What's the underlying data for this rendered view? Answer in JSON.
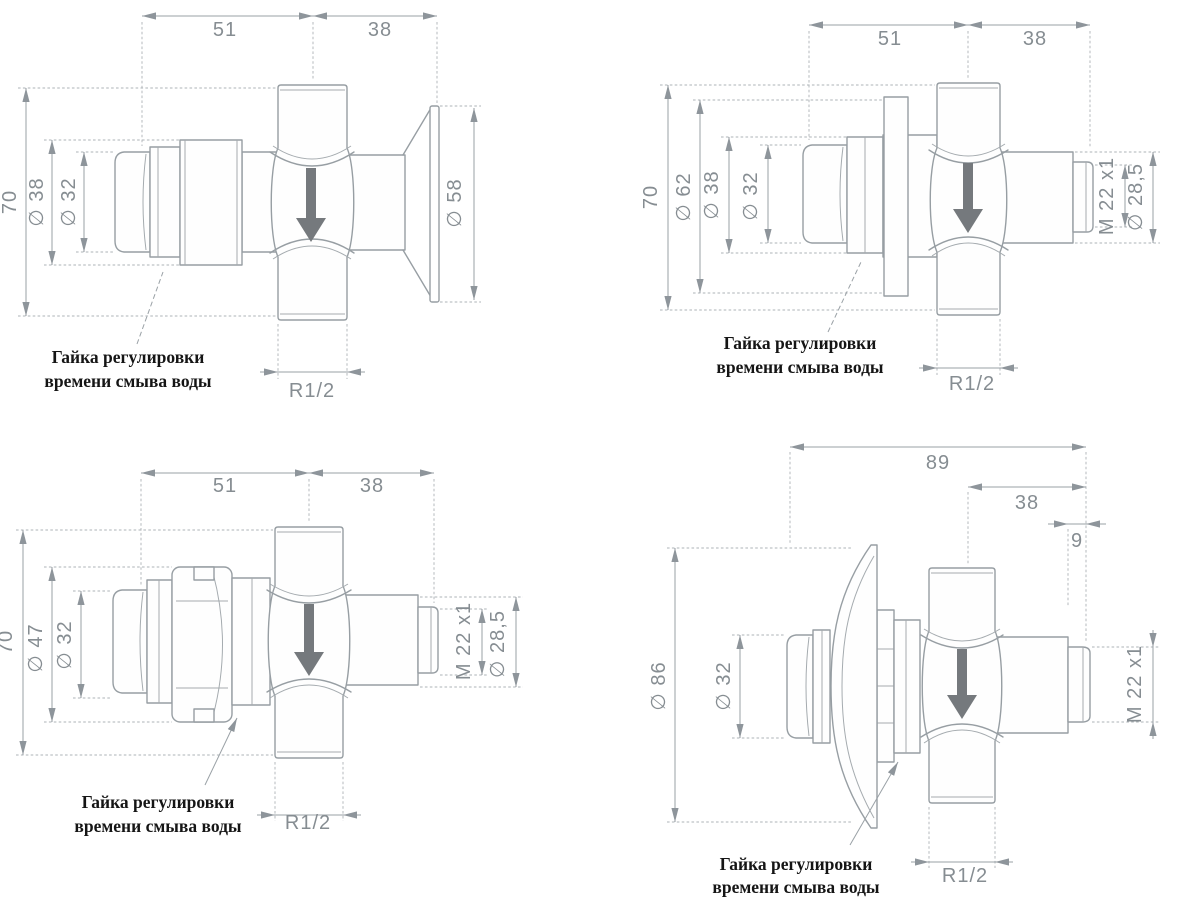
{
  "note": {
    "line1": "Гайка регулировки",
    "line2": "времени смыва воды"
  },
  "drawings": {
    "top_left": {
      "dim_h1": "51",
      "dim_h2": "38",
      "dim_height": "70",
      "dia_body": "∅ 38",
      "dia_button": "∅ 32",
      "dia_flange": "∅ 58",
      "thread_pipe": "R1/2"
    },
    "top_right": {
      "dim_h1": "51",
      "dim_h2": "38",
      "dim_height": "70",
      "dia_flange": "∅ 62",
      "dia_body": "∅ 38",
      "dia_button": "∅ 32",
      "thread_outlet": "M 22 x1",
      "dia_outlet": "∅ 28,5",
      "thread_pipe": "R1/2"
    },
    "bottom_left": {
      "dim_h1": "51",
      "dim_h2": "38",
      "dim_height": "70",
      "dia_nut": "∅ 47",
      "dia_button": "∅ 32",
      "thread_outlet": "M 22 x1",
      "dia_outlet": "∅ 28,5",
      "thread_pipe": "R1/2"
    },
    "bottom_right": {
      "dim_total": "89",
      "dim_h2": "38",
      "dim_tip": "9",
      "dia_flange": "∅ 86",
      "dia_button": "∅ 32",
      "thread_outlet": "M 22 x1",
      "thread_pipe": "R1/2"
    }
  },
  "colors": {
    "line": "#979ea3",
    "dimension": "#99a0a6",
    "dim_text": "#868d92",
    "note_text": "#151515",
    "flow_arrow": "#75797d",
    "background": "#ffffff"
  }
}
